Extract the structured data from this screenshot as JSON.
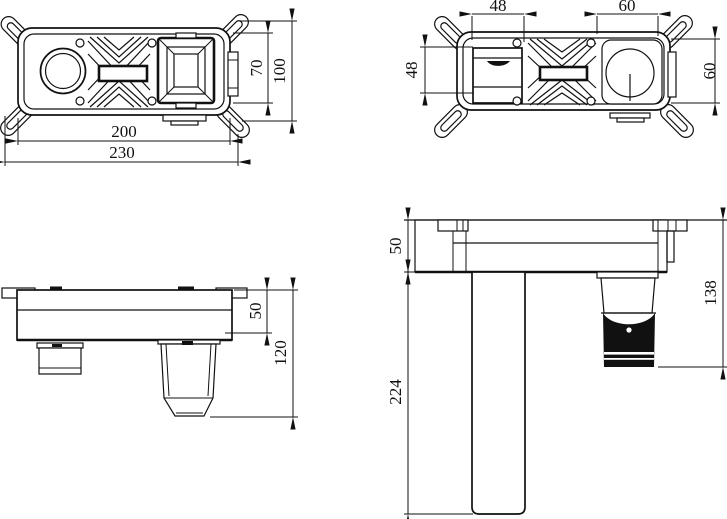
{
  "drawing": {
    "background": "#ffffff",
    "line_color": "#111111",
    "views": {
      "box_front": {
        "dims": {
          "body_width": "200",
          "overall_width": "230",
          "body_height": "70",
          "overall_height": "100"
        }
      },
      "box_back": {
        "dims": {
          "square_width": "48",
          "square_height": "48",
          "knob_width": "60",
          "knob_height": "60"
        }
      },
      "box_side": {
        "dims": {
          "box_depth": "50",
          "overall_depth": "120"
        }
      },
      "faucet_side": {
        "dims": {
          "plate_depth": "50",
          "handle_length": "224",
          "spout_length": "138"
        }
      }
    }
  }
}
